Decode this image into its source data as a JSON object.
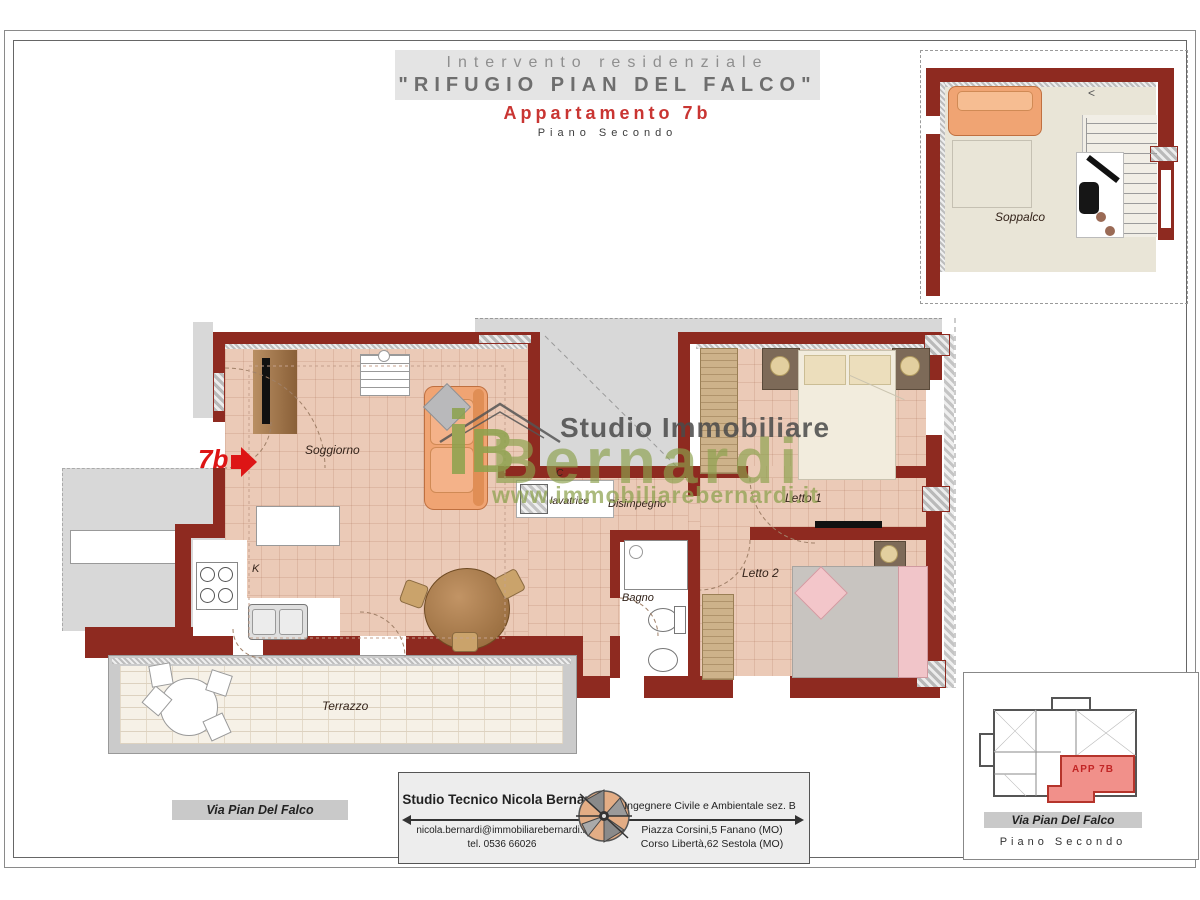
{
  "header": {
    "line1": "Intervento residenziale",
    "line2": "\"RIFUGIO PIAN DEL FALCO\"",
    "line3": "Appartamento 7b",
    "line4": "Piano Secondo"
  },
  "watermark": {
    "name1": "Studio Immobiliare",
    "name2": "Bernardi",
    "url": "www.immobiliarebernardi.it"
  },
  "plan": {
    "unit_arrow_label": "7b",
    "rooms": {
      "soggiorno": "Soggiorno",
      "kitchen": "K",
      "closet": "C",
      "lavatrice": "lavatrice",
      "disimpegno": "Disimpegno",
      "bagno": "Bagno",
      "letto1": "Letto 1",
      "letto2": "Letto 2",
      "terrazzo": "Terrazzo"
    }
  },
  "inset": {
    "room": "Soppalco",
    "stairs_arrow": "<"
  },
  "street_bar": {
    "label": "Via Pian Del Falco"
  },
  "footer_box": {
    "firm": "Studio Tecnico Nicola Bernardi",
    "email": "nicola.bernardi@immobiliarebernardi.it",
    "phone": "tel. 0536 66026",
    "title": "Ingegnere Civile e Ambientale sez. B",
    "address1": "Piazza Corsini,5  Fanano (MO)",
    "address2": "Corso Libertà,62 Sestola (MO)"
  },
  "keyplan": {
    "unit": "APP 7B",
    "street": "Via Pian Del Falco",
    "floor": "Piano Secondo"
  },
  "colors": {
    "wall": "#8e2a20",
    "floor": "#ebcab7",
    "accent_red": "#c93532",
    "watermark_green": "#8ca24d",
    "neighbor_gray": "#d8d8d8"
  }
}
